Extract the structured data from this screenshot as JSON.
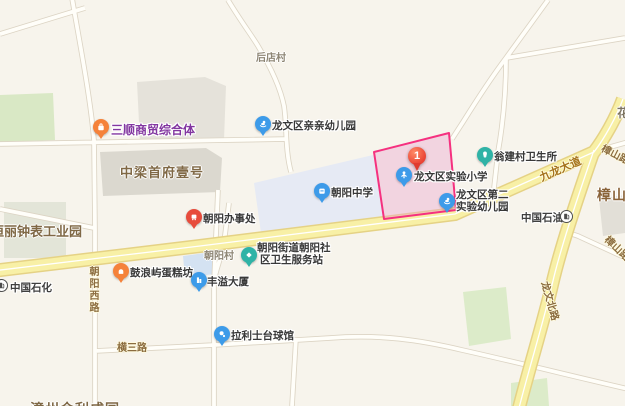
{
  "marker": {
    "label": "1"
  },
  "pois": {
    "sanshun": {
      "label": "三顺商贸综合体"
    },
    "qinqin": {
      "label": "龙文区亲亲幼儿园"
    },
    "banshichu": {
      "label": "朝阳办事处"
    },
    "zhongxue": {
      "label": "朝阳中学"
    },
    "shiyan_xiaoxue": {
      "label": "龙文区实验小学"
    },
    "dier_youeryuan": {
      "line1": "龙文区第二",
      "line2": "实验幼儿园"
    },
    "wengjian": {
      "label": "翁建村卫生所"
    },
    "shequ": {
      "line1": "朝阳街道朝阳社",
      "line2": "区卫生服务站"
    },
    "gulangyu": {
      "label": "鼓浪屿蛋糕坊"
    },
    "fengyi": {
      "label": "丰溢大厦"
    },
    "lalishi": {
      "label": "拉利士台球馆"
    },
    "sinopec": {
      "label": "中国石化"
    },
    "petrochina": {
      "label": "中国石油"
    }
  },
  "areas": {
    "houdiancun": {
      "label": "后店村"
    },
    "chaoyangcun": {
      "label": "朝阳村"
    },
    "zhongliang": {
      "label": "中梁首府壹号"
    },
    "hengli": {
      "label": "恒丽钟表工业园"
    },
    "zhangshan_huayuan": {
      "label": "樟山花园"
    },
    "zhangzhou_partial": {
      "label": "漳州金利成园"
    },
    "corner_partial": {
      "label": "花"
    }
  },
  "roads": {
    "jiulong_dadao": {
      "label": "九龙大道"
    },
    "longwen_beilu": {
      "label": "龙文北路"
    },
    "chaoyang_xilu": {
      "label": "朝阳西路"
    },
    "hengsan_lu": {
      "label": "横三路"
    },
    "zhangshan_lu_ne": {
      "label": "樟山路"
    },
    "zhangshan_lu_se": {
      "label": "樟山路"
    }
  },
  "icons": {
    "sanshun": "shopping-bag-icon",
    "qinqin": "kindergarten-icon",
    "banshichu": "government-office-icon",
    "zhongxue": "school-icon",
    "shiyan_xiaoxue": "primary-school-icon",
    "dier_youeryuan": "kindergarten-icon",
    "wengjian": "clinic-tooth-icon",
    "shequ": "health-station-icon",
    "gulangyu": "bakery-icon",
    "fengyi": "building-icon",
    "lalishi": "billiards-icon",
    "sinopec": "gas-pump-icon",
    "petrochina": "gas-pump-icon",
    "marker": "numbered-marker-icon"
  },
  "colors": {
    "parcel_highlight_border": "#F5317F",
    "parcel_highlight_fill": "#EBA8CF",
    "pin_blue": "#3D9BE9",
    "pin_orange": "#F5823A",
    "pin_teal": "#2FB3A6",
    "pin_red": "#E74C3C",
    "marker_red": "#EA4335",
    "road_major_fill": "#F8F0A6",
    "campus_fill": "#E6EAF4",
    "green_fill": "#DCEBC9"
  }
}
